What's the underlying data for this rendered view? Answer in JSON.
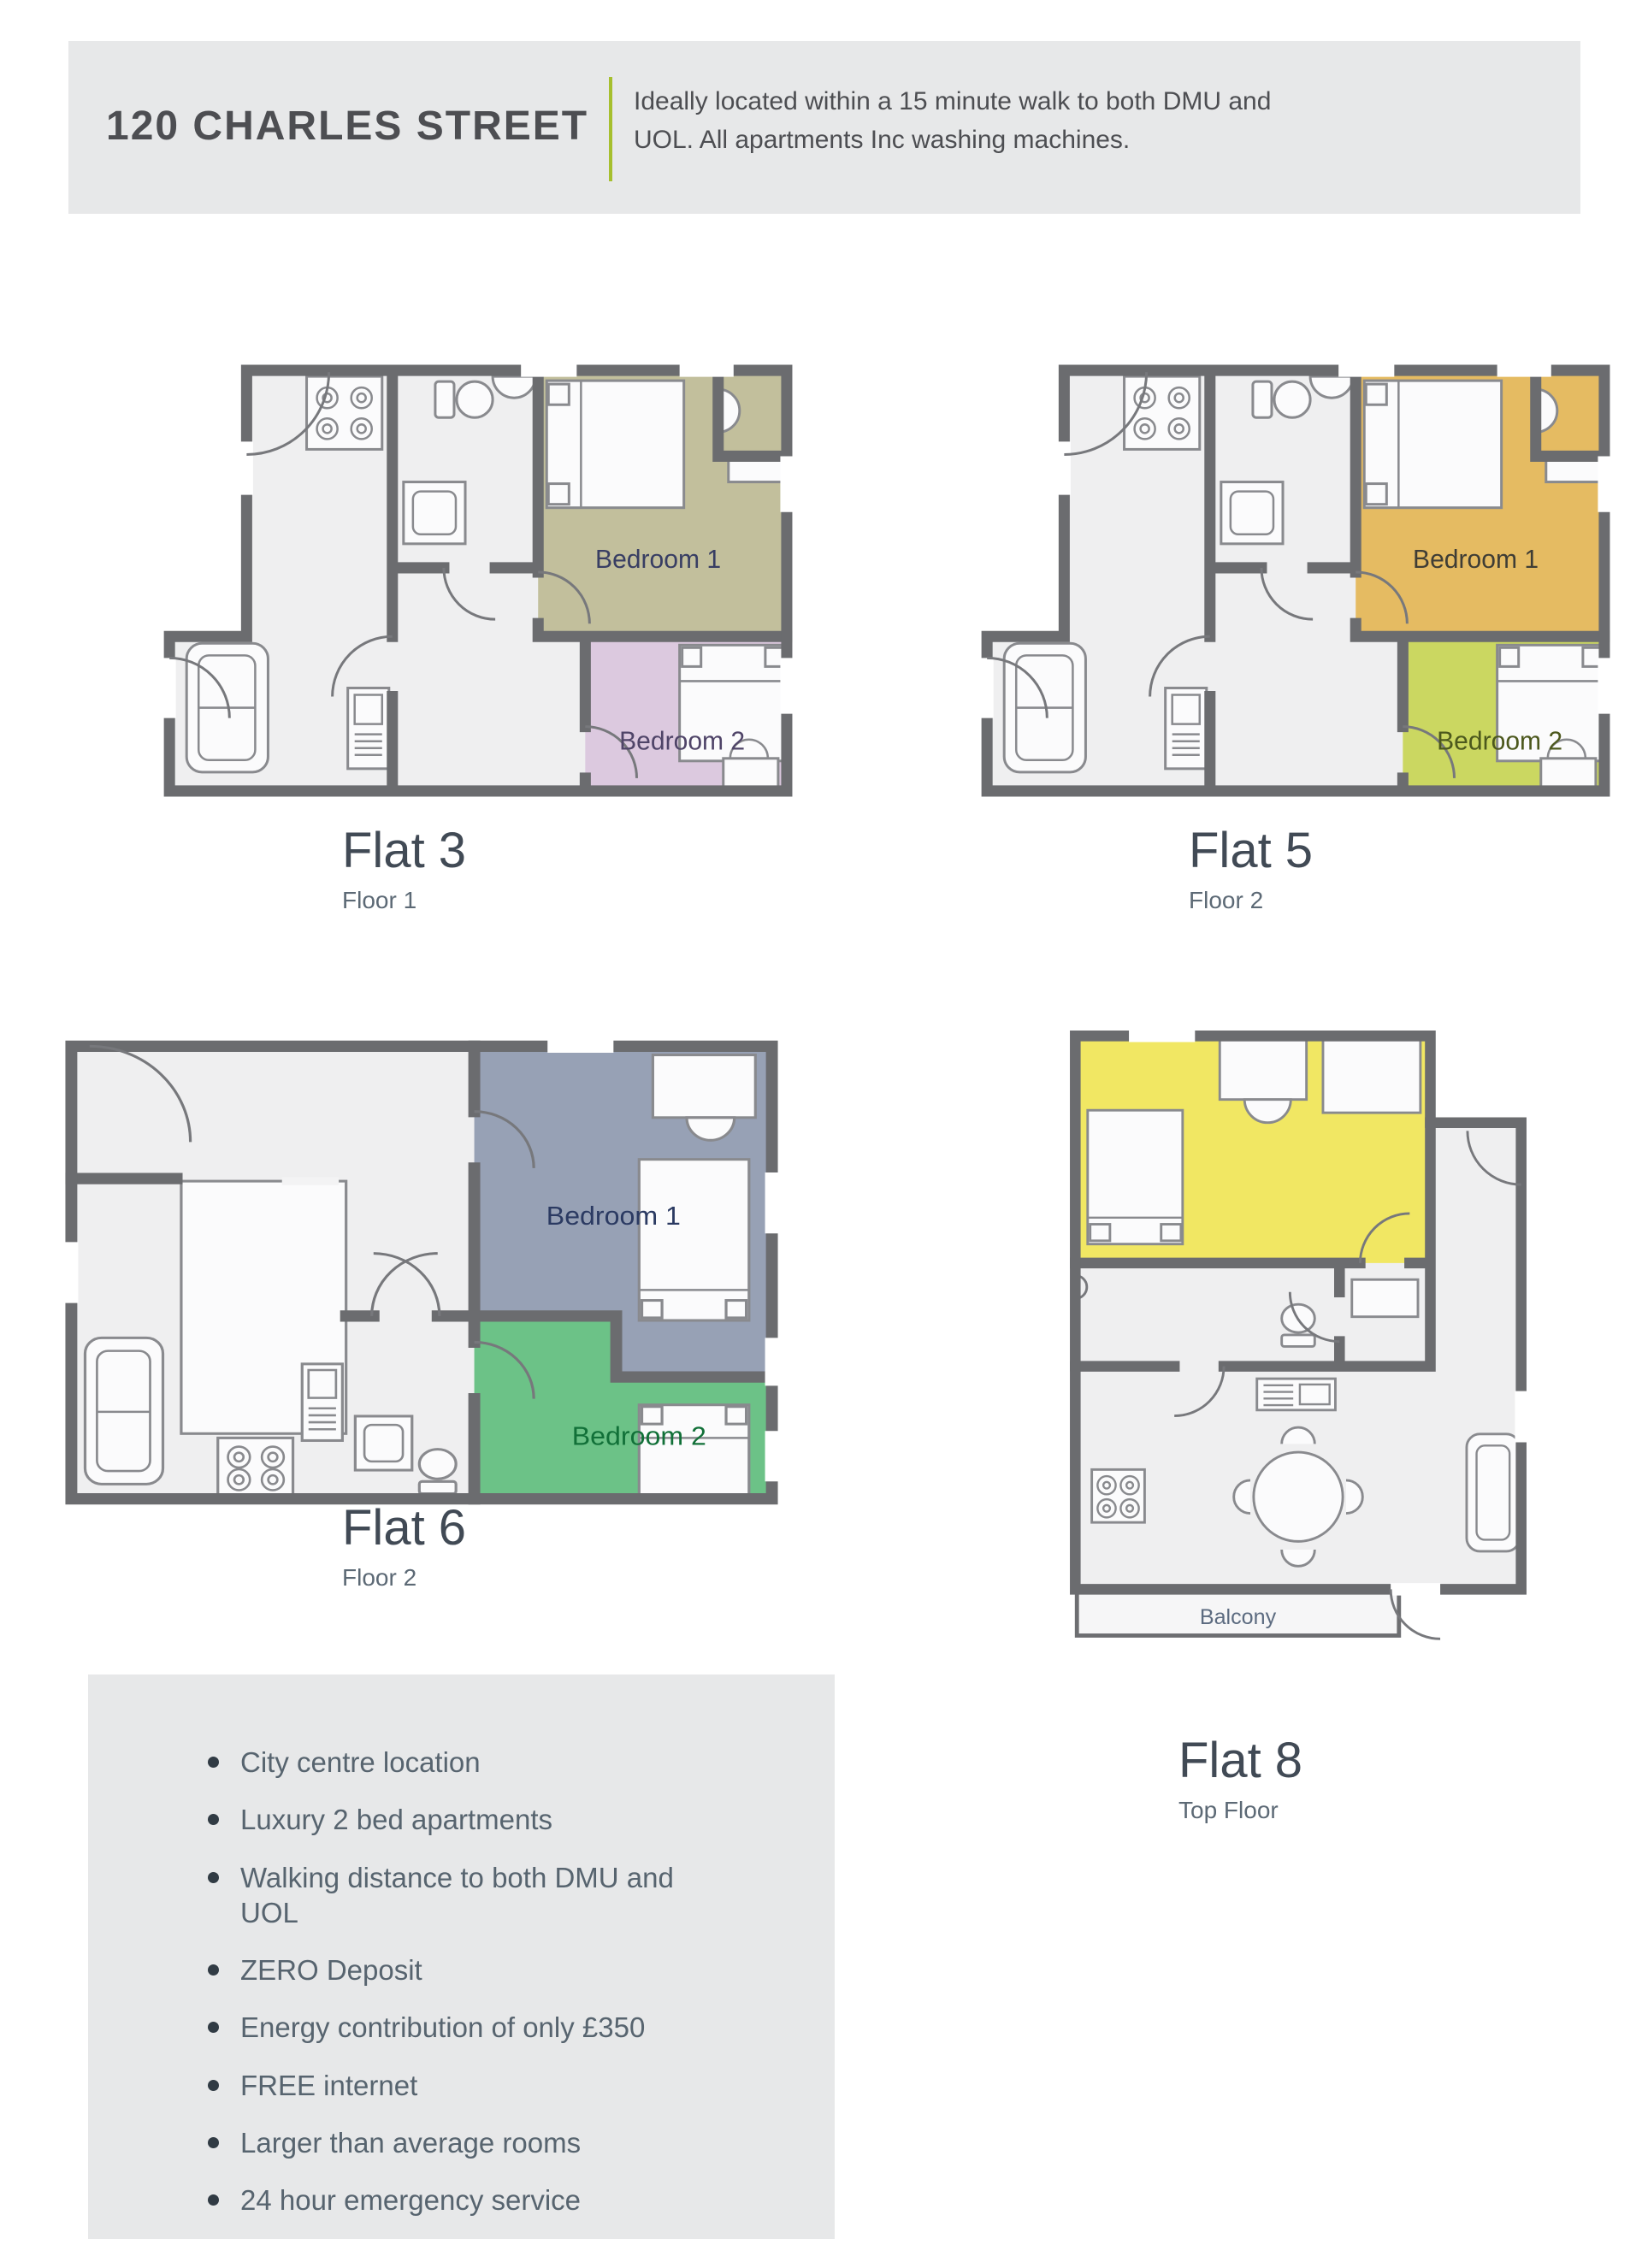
{
  "header": {
    "title": "120 CHARLES STREET",
    "description": "Ideally located within a 15 minute walk to both DMU and UOL. All apartments Inc washing machines.",
    "divider_color": "#a6bf2e"
  },
  "flats": [
    {
      "name": "Flat 3",
      "floor": "Floor 1",
      "bedroom1_label": "Bedroom 1",
      "bedroom2_label": "Bedroom 2",
      "bedroom1_color": "#c2bf9c",
      "bedroom2_color": "#dcc9df",
      "bedroom1_text": "#383e63",
      "bedroom2_text": "#4f4468"
    },
    {
      "name": "Flat 5",
      "floor": "Floor 2",
      "bedroom1_label": "Bedroom 1",
      "bedroom2_label": "Bedroom 2",
      "bedroom1_color": "#e5bb62",
      "bedroom2_color": "#cbd761",
      "bedroom1_text": "#3f3d35",
      "bedroom2_text": "#4c581d"
    },
    {
      "name": "Flat 6",
      "floor": "Floor 2",
      "bedroom1_label": "Bedroom 1",
      "bedroom2_label": "Bedroom 2",
      "bedroom1_color": "#97a1b5",
      "bedroom2_color": "#6cc287",
      "bedroom1_text": "#2b3a62",
      "bedroom2_text": "#117038"
    },
    {
      "name": "Flat 8",
      "floor": "Top Floor",
      "bedroom_color": "#f1e763",
      "balcony_label": "Balcony",
      "balcony_text": "#5c6b80"
    }
  ],
  "features": {
    "items": [
      "City centre location",
      "Luxury 2 bed apartments",
      "Walking distance to both DMU and UOL",
      "ZERO Deposit",
      "Energy contribution of only £350",
      "FREE internet",
      "Larger than average rooms",
      "24 hour emergency service"
    ]
  },
  "colors": {
    "wall": "#6b6c6f",
    "floor": "#efeff0",
    "panel_bg": "#e7e8e9"
  }
}
